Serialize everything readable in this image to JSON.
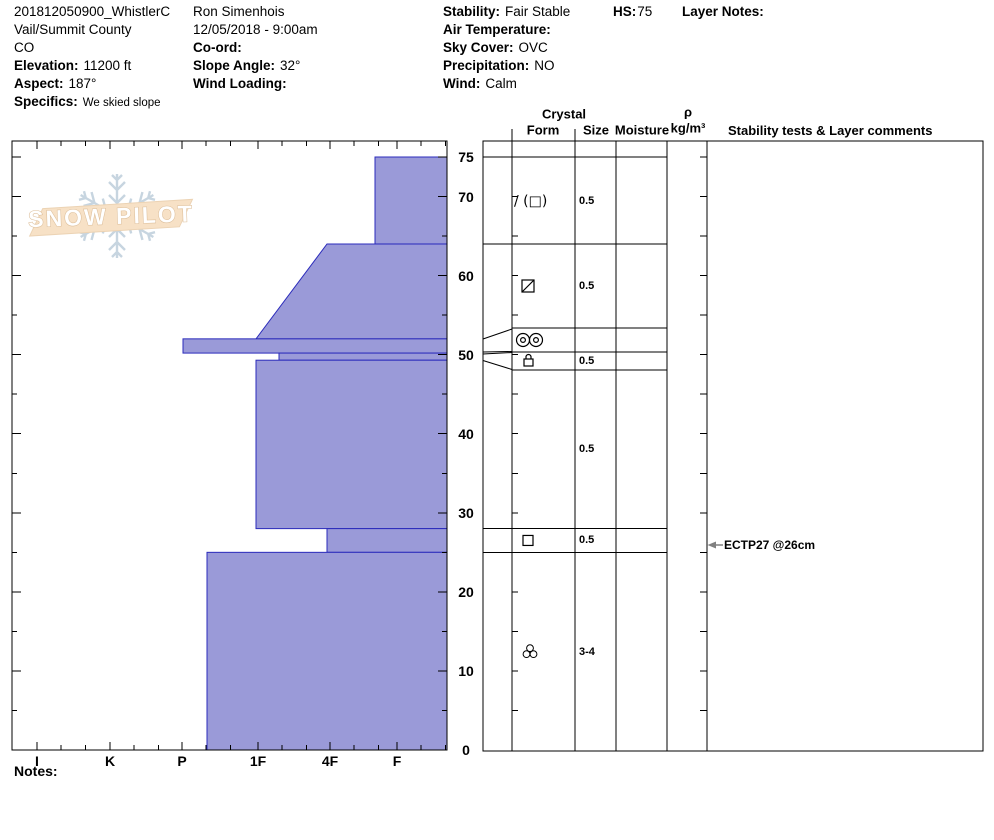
{
  "header": {
    "col1": [
      {
        "label": "",
        "value": "201812050900_WhistlerC"
      },
      {
        "label": "",
        "value": "Vail/Summit County"
      },
      {
        "label": "",
        "value": "CO"
      },
      {
        "label": "Elevation:",
        "value": "11200 ft"
      },
      {
        "label": "Aspect:",
        "value": "187°"
      },
      {
        "label": "Specifics:",
        "value": "We skied slope",
        "small": true
      }
    ],
    "col2": [
      {
        "label": "",
        "value": "Ron Simenhois"
      },
      {
        "label": "",
        "value": "12/05/2018 - 9:00am"
      },
      {
        "label": "Co-ord:",
        "value": ""
      },
      {
        "label": "Slope Angle:",
        "value": "32°"
      },
      {
        "label": "Wind Loading:",
        "value": ""
      }
    ],
    "col3": [
      {
        "label": "Stability:",
        "value": "Fair Stable"
      },
      {
        "label": "Air Temperature:",
        "value": ""
      },
      {
        "label": "Sky Cover:",
        "value": "OVC"
      },
      {
        "label": "Precipitation:",
        "value": "NO"
      },
      {
        "label": "Wind:",
        "value": "Calm"
      }
    ],
    "hs": {
      "label": "HS:",
      "value": "75"
    },
    "layer_notes": {
      "label": "Layer Notes:"
    }
  },
  "table_headers": {
    "crystal": "Crystal",
    "form": "Form",
    "size": "Size",
    "moisture": "Moisture",
    "rho": "ρ",
    "rho_unit": "kg/m³",
    "stability": "Stability tests & Layer comments"
  },
  "logo": {
    "text": "SNOW PILOT"
  },
  "ect": {
    "text": "ECTP27 @26cm"
  },
  "notes_label": "Notes:",
  "chart_data": {
    "type": "bar",
    "title": "Snow pit hardness profile",
    "xlabel": "Hand hardness",
    "ylabel": "Depth (cm)",
    "total_depth_cm": 75,
    "hardness_categories": [
      "I",
      "K",
      "P",
      "1F",
      "4F",
      "F"
    ],
    "depth_ticks": [
      {
        "cm": 75,
        "label": "75"
      },
      {
        "cm": 70,
        "label": "70"
      },
      {
        "cm": 60,
        "label": "60"
      },
      {
        "cm": 50,
        "label": "50"
      },
      {
        "cm": 40,
        "label": "40"
      },
      {
        "cm": 30,
        "label": "30"
      },
      {
        "cm": 20,
        "label": "20"
      },
      {
        "cm": 10,
        "label": "10"
      },
      {
        "cm": 0,
        "label": "0"
      }
    ],
    "layers": [
      {
        "top_cm": 75,
        "bottom_cm": 64,
        "hardness": "F",
        "grain_form": "slash_paren_square",
        "grain_form_text": "/ (□)",
        "size_mm": "0.5"
      },
      {
        "top_cm": 64,
        "bottom_cm": 52,
        "hardness": "4F to 1F",
        "grain_form": "square_diagonal",
        "grain_form_text": "⧄",
        "size_mm": "0.5"
      },
      {
        "top_cm": 52,
        "bottom_cm": 50.2,
        "hardness": "P",
        "grain_form": "double_circles",
        "grain_form_text": "◎◎",
        "size_mm": ""
      },
      {
        "top_cm": 50.2,
        "bottom_cm": 49.3,
        "hardness": "1F+",
        "grain_form": "lock",
        "grain_form_text": "⌂",
        "size_mm": "0.5"
      },
      {
        "top_cm": 49.3,
        "bottom_cm": 28,
        "hardness": "1F",
        "grain_form": "",
        "grain_form_text": "",
        "size_mm": "0.5"
      },
      {
        "top_cm": 28,
        "bottom_cm": 25,
        "hardness": "4F",
        "grain_form": "square",
        "grain_form_text": "□",
        "size_mm": "0.5"
      },
      {
        "top_cm": 25,
        "bottom_cm": 0,
        "hardness": "P+",
        "grain_form": "cluster",
        "grain_form_text": "⸬",
        "size_mm": "3-4"
      }
    ],
    "annotations": [
      {
        "text": "ECTP27 @26cm",
        "depth_cm": 26
      }
    ],
    "legend_position": "none",
    "grid": false,
    "colors": {
      "bar_fill": "#9a9ad8",
      "bar_stroke": "#2b2bbb",
      "frame": "#000000",
      "annotation_arrow": "#808080",
      "logo_band": "#f7e1c6",
      "logo_band_edge": "#ecd3b4",
      "logo_snowflake": "#c7d5e0",
      "logo_text_stroke": "#dcbd98"
    },
    "render": {
      "chart_px": {
        "left": 12,
        "right": 447,
        "top": 141,
        "bottom": 750,
        "surface_y": 157
      },
      "hardness_x": {
        "I": 37,
        "K": 110,
        "P": 182,
        "1F": 258,
        "4F": 330,
        "F": 397
      },
      "layer_left_px": [
        375,
        [
          327,
          256
        ],
        183,
        279,
        256,
        327,
        207
      ],
      "table_px": {
        "cols": [
          483,
          512,
          575,
          616,
          667,
          707,
          983
        ],
        "top": 141,
        "bottom": 751,
        "row_bounds": [
          157,
          244,
          328,
          352,
          370,
          528.6,
          552.3,
          751
        ],
        "row_lines_full": [
          244,
          528.6,
          552.3
        ],
        "row_lines_expanded": [
          328,
          352,
          370
        ],
        "funnels": [
          [
            339,
            329
          ],
          [
            352,
            351.5
          ],
          [
            354,
            352.5
          ],
          [
            360.5,
            369.5
          ]
        ]
      },
      "depth_label_x": 466,
      "hardness_label_y": 761,
      "size_col_x": 579,
      "form_col_x": 528,
      "logo_center": [
        117,
        216
      ],
      "annotation_y": 545
    }
  }
}
